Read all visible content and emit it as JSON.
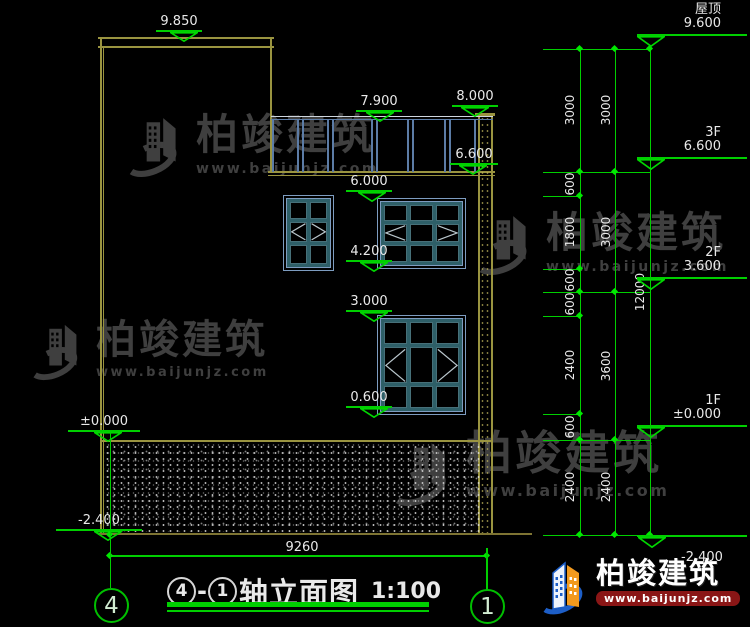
{
  "watermark": {
    "brand": "柏竣建筑",
    "url": "www.baijunjz.com"
  },
  "logo": {
    "brand": "柏竣建筑",
    "url": "www.baijunjz.com"
  },
  "markers": {
    "p9850": "9.850",
    "p7900": "7.900",
    "p8000": "8.000",
    "p6600": "6.600",
    "p6000": "6.000",
    "p4200": "4.200",
    "p3000": "3.000",
    "p0600": "0.600",
    "zero": "±0.000",
    "n2400": "-2.400"
  },
  "levels": {
    "roof_label": "屋顶",
    "roof_value": "9.600",
    "f3_label": "3F",
    "f3_value": "6.600",
    "f2_label": "2F",
    "f2_value": "3.600",
    "f1_label": "1F",
    "f1_value": "±0.000",
    "base_value": "-2.400"
  },
  "dims": {
    "inner": [
      "3000",
      "600",
      "1800",
      "600",
      "600",
      "2400",
      "600",
      "2400"
    ],
    "floors": [
      "3000",
      "3000",
      "3600",
      "2400"
    ],
    "total": "12000",
    "width": "9260"
  },
  "axes": {
    "left": "4",
    "right": "1"
  },
  "title": {
    "grid_from": "4",
    "dash": "-",
    "grid_to": "1",
    "name": "轴立面图",
    "scale": "1:100"
  }
}
